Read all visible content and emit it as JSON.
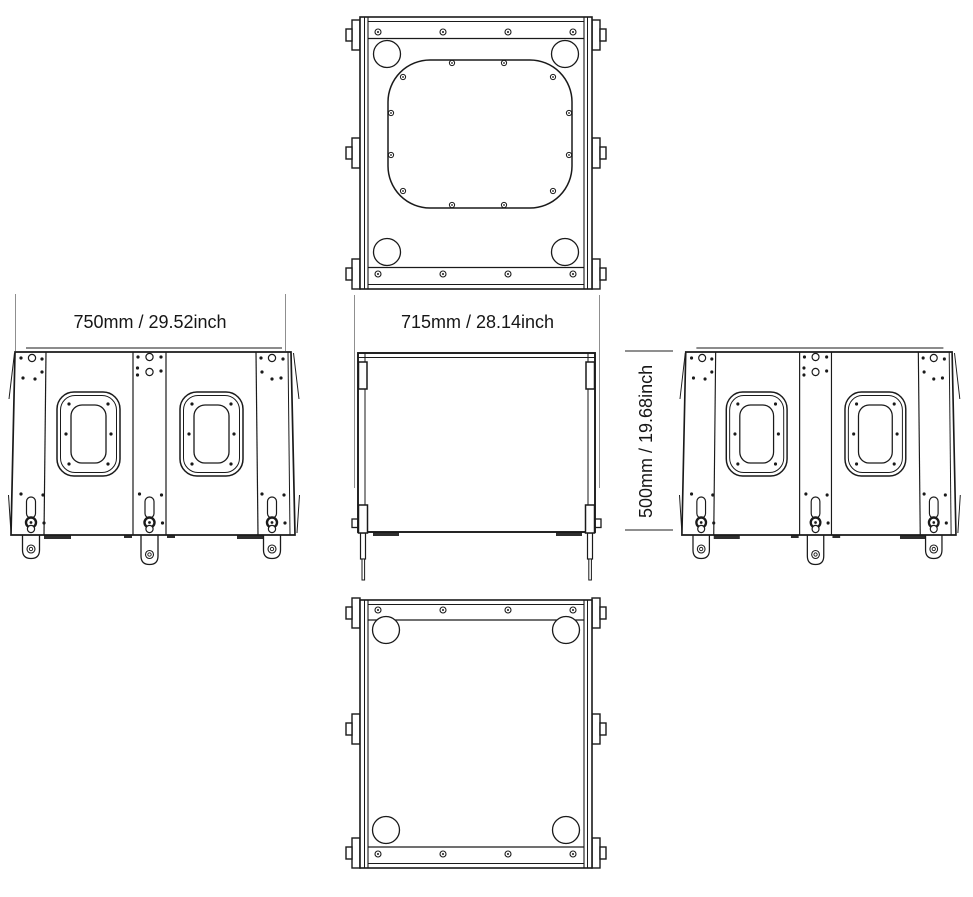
{
  "drawing": {
    "type": "loudspeaker-enclosure-dimension-drawing",
    "views": [
      "top",
      "left-side",
      "front",
      "right-side",
      "bottom"
    ],
    "dimensions": {
      "side_width": "750mm / 29.52inch",
      "front_width": "715mm / 28.14inch",
      "height": "500mm / 19.68inch"
    },
    "colors": {
      "line": "#1a1a1a",
      "dimension_line": "#8f8f8f",
      "text": "#161616",
      "foot_fill": "#2e2e2e",
      "background": "#ffffff"
    }
  }
}
